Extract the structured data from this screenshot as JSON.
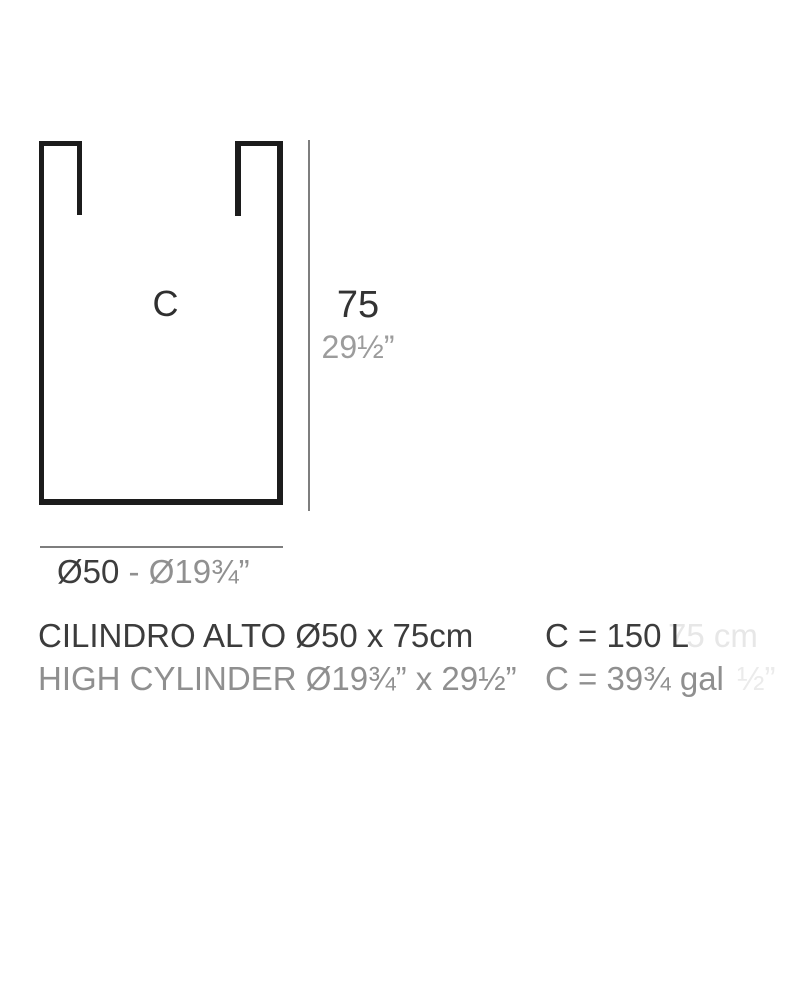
{
  "page": {
    "background_color": "#ffffff"
  },
  "diagram": {
    "vessel_label": "C",
    "height_dim_cm": "75",
    "height_dim_in": "29½”",
    "diameter_dim": {
      "cm": "Ø50",
      "separator": " - ",
      "in": "Ø19¾”"
    }
  },
  "caption": {
    "title_metric": "CILINDRO ALTO Ø50 x 75cm",
    "title_imperial": "HIGH CYLINDER Ø19¾” x 29½”"
  },
  "capacity": {
    "liters": "C = 150 L",
    "gallons": "C = 39¾ gal"
  },
  "ghost_text": {
    "line1_fragment": "75 cm",
    "line2_fragment": "½”"
  },
  "colors": {
    "outline": "#1c1c1c",
    "dimension_line": "#7e7e7e",
    "text_dark": "#3c3c3c",
    "text_gray": "#8f8f8f",
    "text_light_gray": "#9c9c9c",
    "text_ghost": "#e7e7e7"
  }
}
